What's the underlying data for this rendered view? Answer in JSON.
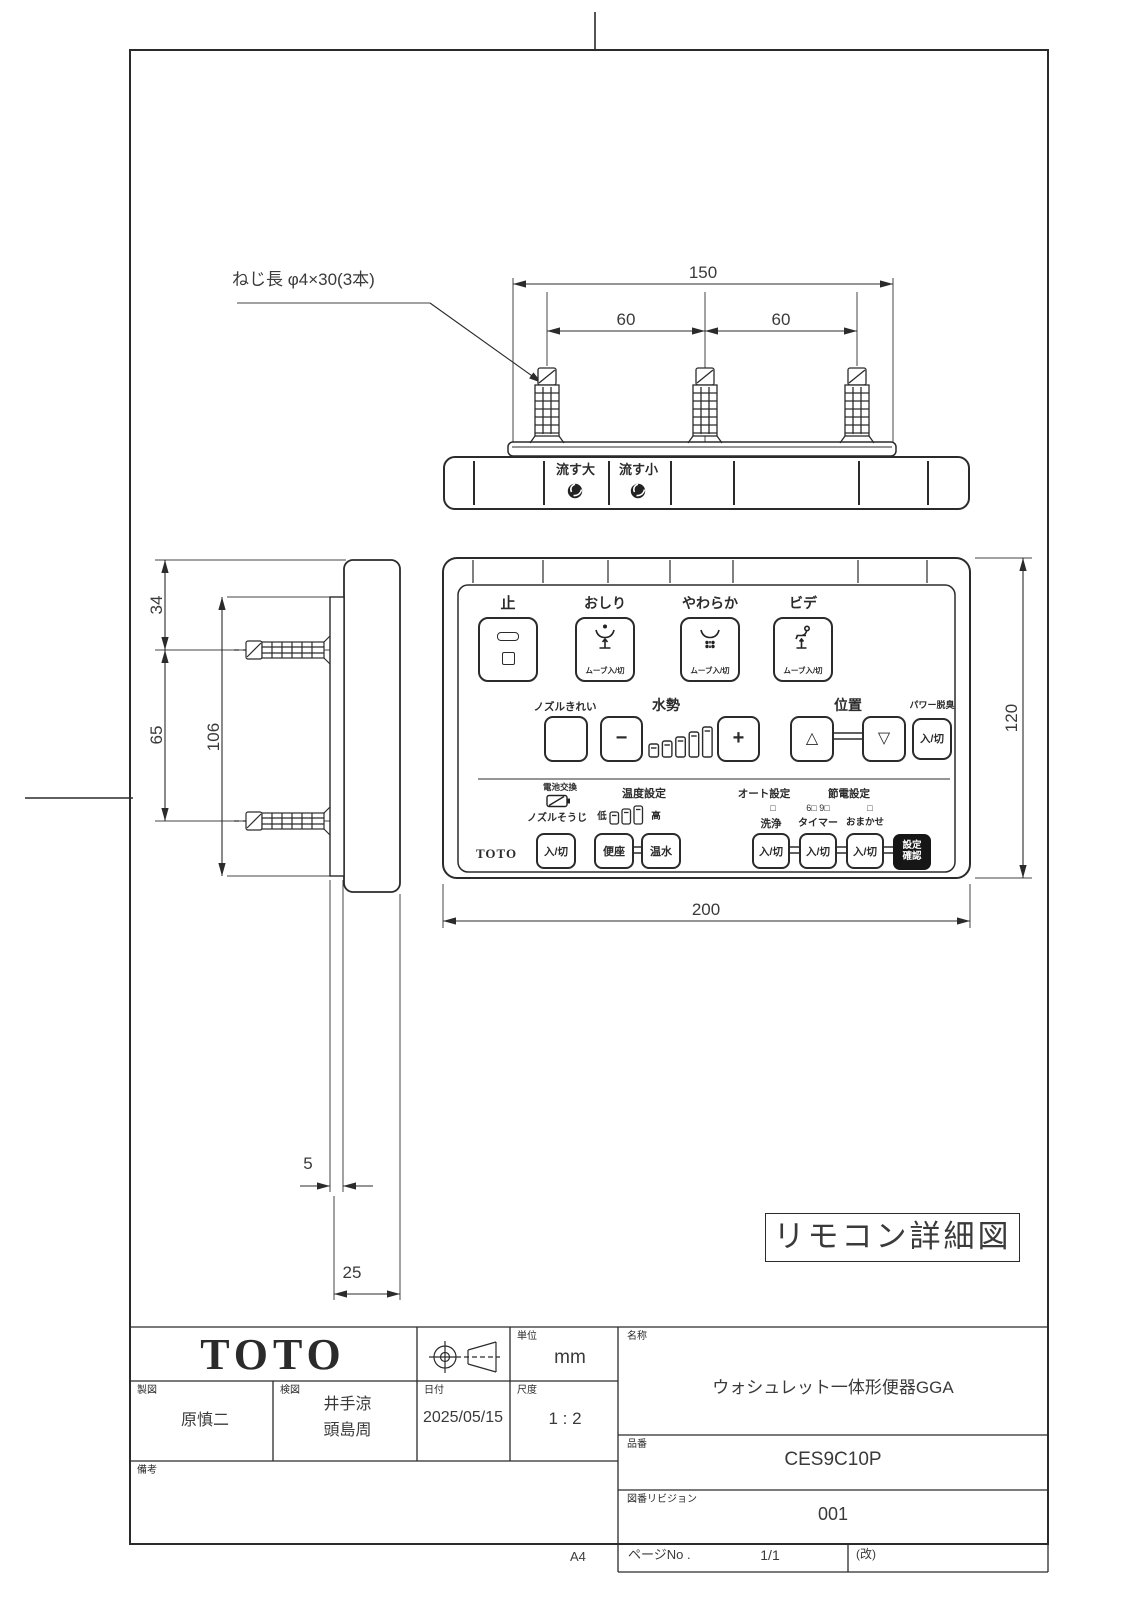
{
  "colors": {
    "line": "#2b2b2b",
    "background": "#ffffff",
    "confirm_button_fill": "#161616",
    "confirm_button_text": "#ffffff"
  },
  "note": {
    "screw": "ねじ長 φ4×30(3本)"
  },
  "dims": {
    "overall_width": "150",
    "screw_pitch_left": "60",
    "screw_pitch_right": "60",
    "top_offset": "34",
    "screw_pitch_side": "65",
    "plate_height": "106",
    "plate_thickness": "5",
    "body_depth": "25",
    "remote_width": "200",
    "remote_height": "120"
  },
  "top_view": {
    "flush_large": "流す大",
    "flush_small": "流す小"
  },
  "front": {
    "row1": {
      "stop": "止",
      "rear": "おしり",
      "soft": "やわらか",
      "bidet": "ビデ",
      "move": "ムーブ入/切"
    },
    "row2": {
      "nozzle_clean": "ノズルきれい",
      "water": "水勢",
      "minus": "−",
      "plus": "+",
      "position": "位置",
      "up": "△",
      "down": "▽",
      "deodorize": "パワー脱臭",
      "onoff": "入/切"
    },
    "row3": {
      "battery": "電池交換",
      "temp": "温度設定",
      "auto": "オート設定",
      "eco": "節電設定",
      "nozzle_wash": "ノズルそうじ",
      "low": "低",
      "high": "高",
      "seat": "便座",
      "hot_water": "温水",
      "ind_wash": "□",
      "ind_timer": "6□ 9□",
      "ind_entrust": "□",
      "wash": "洗浄",
      "timer": "タイマー",
      "entrust": "おまかせ",
      "onoff": "入/切",
      "set1": "設定",
      "set2": "確認",
      "brand": "TOTO"
    }
  },
  "stamp": {
    "text": "リモコン詳細図"
  },
  "title_block": {
    "logo": "TOTO",
    "unit_label": "単位",
    "unit": "mm",
    "draft_label": "製図",
    "draft": "原慎二",
    "check_label": "検図",
    "check1": "井手涼",
    "check2": "頭島周",
    "date_label": "日付",
    "date": "2025/05/15",
    "scale_label": "尺度",
    "scale": "1 : 2",
    "notes_label": "備考",
    "name_label": "名称",
    "name": "ウォシュレット一体形便器GGA",
    "part_label": "品番",
    "part": "CES9C10P",
    "rev_label": "図番リビジョン",
    "rev": "001",
    "page_label": "ページNo .",
    "page": "1/1",
    "rev_mark": "(改)",
    "paper": "A4"
  },
  "icons": {
    "flush": "swirl",
    "stop": "bar-and-square",
    "rear_wash": "rear-spray",
    "soft_wash": "soft-spray",
    "bidet": "seated-person-spray",
    "battery": "battery-replace",
    "projection": "third-angle-projection-symbol"
  }
}
